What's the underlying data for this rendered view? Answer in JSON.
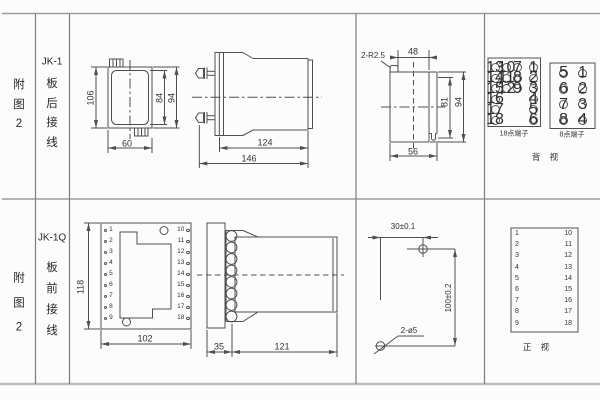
{
  "colors": {
    "line": "#4f4f4f",
    "text": "#303030",
    "grid": "#9c9c9c"
  },
  "row_top": {
    "fig_label": "附图2",
    "model": "JK-1",
    "wiring": "板后接线",
    "front_view": {
      "dim_height_outer": "106",
      "dim_height_inner": "84",
      "dim_height_right": "94",
      "dim_width_bottom": "60"
    },
    "side_view": {
      "dim_depth_body": "124",
      "dim_depth_total": "146"
    },
    "rear_cut_view": {
      "note_corner_radius": "2-R2.5",
      "dim_width_top": "48",
      "dim_height_inner": "81",
      "dim_height_outer": "94",
      "dim_width_bottom": "56"
    },
    "terminal_block_18": {
      "label": "18点端子",
      "col1": [
        "13",
        "14",
        "15",
        "16",
        "17",
        "18"
      ],
      "col2": [
        "10",
        "11",
        "12"
      ],
      "col3": [
        "7",
        "8",
        "9"
      ],
      "col4": [
        "1",
        "2",
        "3",
        "4",
        "5",
        "6"
      ]
    },
    "terminal_block_8": {
      "label": "8点端子",
      "col1": [
        "5",
        "6",
        "7",
        "8"
      ],
      "col2": [
        "1",
        "2",
        "3",
        "4"
      ]
    },
    "view_label": "背 视"
  },
  "row_bottom": {
    "fig_label": "附图2",
    "model": "JK-1Q",
    "wiring": "板前接线",
    "front_view": {
      "dim_height": "118",
      "dim_width": "102",
      "left_terminals": [
        "1",
        "2",
        "3",
        "4",
        "5",
        "6",
        "7",
        "8",
        "9"
      ],
      "right_terminals": [
        "10",
        "11",
        "12",
        "13",
        "14",
        "15",
        "16",
        "17",
        "18"
      ]
    },
    "side_view": {
      "dim_depth_plate": "35",
      "dim_depth_body": "121"
    },
    "drill_view": {
      "dim_hole_spacing_h": "30±0.1",
      "dim_hole_spacing_v": "100±0.2",
      "note_holes": "2-ø5"
    },
    "terminal_table": {
      "left": [
        "1",
        "2",
        "3",
        "4",
        "5",
        "6",
        "7",
        "8",
        "9"
      ],
      "right": [
        "10",
        "11",
        "12",
        "13",
        "14",
        "15",
        "16",
        "17",
        "18"
      ]
    },
    "view_label": "正 视"
  }
}
